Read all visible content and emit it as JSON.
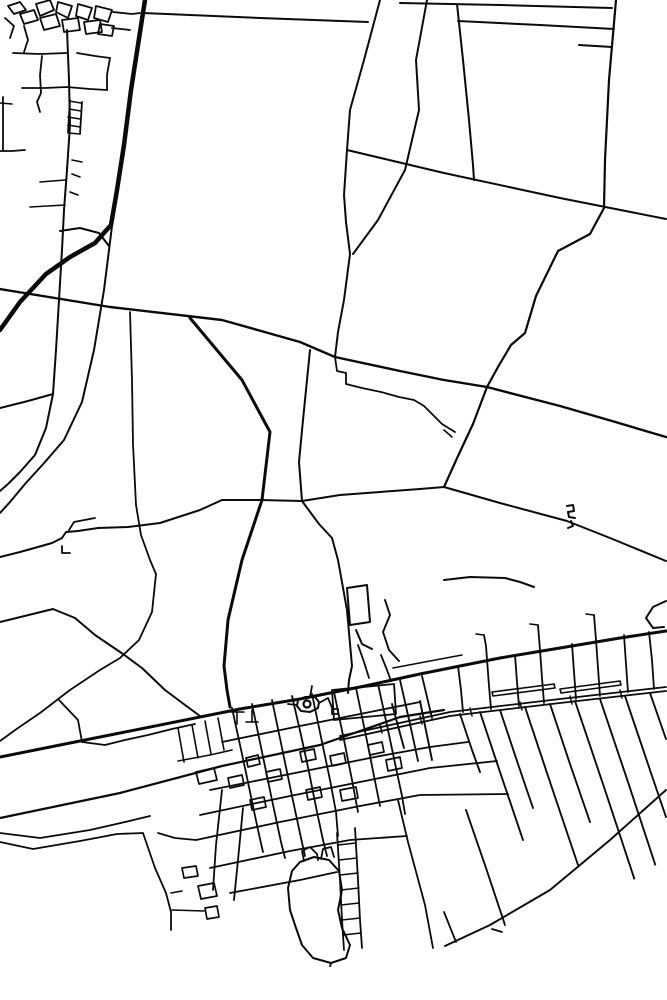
{
  "map": {
    "background": "#ffffff",
    "stroke": "#0a0a0a",
    "canvas": {
      "width": 667,
      "height": 1000
    },
    "clip_circle": {
      "cx": 333,
      "cy": 405,
      "r": 562
    },
    "circles": [
      {
        "cx": 307,
        "cy": 704,
        "r": 3.5,
        "w": 2.2
      }
    ],
    "roads": [
      {
        "w": 1.8,
        "p": "8,6 20,2 26,10 14,14 8,6"
      },
      {
        "w": 1.8,
        "p": "20,14 34,10 38,20 24,24 20,14"
      },
      {
        "w": 1.8,
        "p": "36,4 50,0 54,10 40,16 36,4"
      },
      {
        "w": 1.8,
        "p": "40,18 56,14 60,26 44,30 40,18"
      },
      {
        "w": 1.8,
        "p": "58,2 72,6 68,18 56,12 58,2"
      },
      {
        "w": 1.8,
        "p": "62,20 78,18 80,30 64,32 62,20"
      },
      {
        "w": 1.8,
        "p": "78,4 92,8 88,20 76,16 78,4"
      },
      {
        "w": 1.8,
        "p": "84,22 100,20 102,32 86,34 84,22"
      },
      {
        "w": 1.8,
        "p": "96,6 112,10 108,22 94,18 96,6"
      },
      {
        "w": 1.8,
        "p": "100,24 114,26 112,36 98,34 100,24"
      },
      {
        "w": 1.8,
        "p": "5,18 14,26 10,38"
      },
      {
        "w": 1.8,
        "p": "24,26 28,40 24,52"
      },
      {
        "w": 1.8,
        "p": "113,12 132,14 140,13"
      },
      {
        "w": 1.8,
        "p": "112,28 130,30"
      },
      {
        "w": 1.8,
        "p": "13,53 40,54 67,53"
      },
      {
        "w": 1.8,
        "p": "22,88 45,88 67,87 90,89 107,90"
      },
      {
        "w": 1.8,
        "p": "42,56 40,75 41,93 37,102 40,112"
      },
      {
        "w": 1.8,
        "p": "3,97 3,126 3,150"
      },
      {
        "w": 1.8,
        "p": "0,151 12,151 25,150"
      },
      {
        "w": 1.8,
        "p": "77,53 95,56 110,58"
      },
      {
        "w": 1.8,
        "p": "110,58 107,75 107,90"
      },
      {
        "w": 1.8,
        "p": "70,100 69,116 68,132"
      },
      {
        "w": 1.8,
        "p": "82,102 81,118 80,134"
      },
      {
        "w": 1.6,
        "p": "69,101 81,103"
      },
      {
        "w": 1.6,
        "p": "69,109 81,111"
      },
      {
        "w": 1.6,
        "p": "68,117 80,119"
      },
      {
        "w": 1.6,
        "p": "68,125 80,127"
      },
      {
        "w": 1.6,
        "p": "68,133 80,134"
      },
      {
        "w": 1.6,
        "p": "72,160 82,162"
      },
      {
        "w": 1.6,
        "p": "72,174 80,177"
      },
      {
        "w": 1.6,
        "p": "70,192 78,195"
      },
      {
        "w": 1.6,
        "p": "40,182 65,180"
      },
      {
        "w": 1.6,
        "p": "30,207 65,205"
      },
      {
        "w": 1.6,
        "p": "0,103 12,104"
      },
      {
        "w": 2,
        "p": "67,30 69,80 70,125 67,170 64,210 62,250 59,300 56,350 53,394 46,428 35,455 20,472 8,484 0,491"
      },
      {
        "w": 2,
        "p": "53,394 28,401 0,408"
      },
      {
        "w": 2,
        "p": "60,231 80,228 99,233 109,246"
      },
      {
        "w": 4.5,
        "p": "145,0 138,45 131,90 124,145 117,190 111,225 95,243 70,257 46,274 20,302 0,330"
      },
      {
        "w": 2,
        "p": "112,226 104,290 94,350 82,402 64,440 45,462 25,484 10,502 0,513"
      },
      {
        "w": 1.8,
        "p": "130,312 132,380 133,444 136,505 141,535 150,560 156,574 152,612 139,640 120,658 100,670 70,690 40,713 18,728 0,741"
      },
      {
        "w": 2,
        "p": "143,13 260,18 368,22"
      },
      {
        "w": 2,
        "p": "400,3 500,5 612,8"
      },
      {
        "w": 2,
        "p": "458,21 540,25 614,29"
      },
      {
        "w": 2,
        "p": "579,45 612,47"
      },
      {
        "w": 2,
        "p": "380,0 364,60 350,110 347,150 344,195 346,222 350,254 344,300 338,332 335,357"
      },
      {
        "w": 2,
        "p": "427,0 416,60 419,110 405,170 378,220 353,254"
      },
      {
        "w": 2,
        "p": "347,150 444,173 560,198 666,219"
      },
      {
        "w": 2,
        "p": "457,4 463,60 469,120 473,165 474,180"
      },
      {
        "w": 2.2,
        "p": "616,0 609,80 605,160 604,208 590,234 558,251 536,296 525,333 511,345 498,367 487,387 473,424 458,456 444,487"
      },
      {
        "w": 2.4,
        "p": "0,289 110,307 222,320 300,342 335,357 400,371 444,380 487,387 560,406 612,421 666,437"
      },
      {
        "w": 1.8,
        "p": "335,357 337,371 346,373 346,384 362,388 381,392 399,397 414,400 424,406 442,424 455,432"
      },
      {
        "w": 3,
        "p": "190,318 242,380 270,432 262,500 242,560 228,620 224,666 227,690 230,707"
      },
      {
        "w": 2,
        "p": "310,350 303,420 299,462 302,501 319,524 332,538 338,560 347,610 352,666 349,680 348,693"
      },
      {
        "w": 2,
        "p": "0,557 20,552 38,547 52,543 62,538 66,532 78,531 98,528 128,527 160,523 200,510 222,500 260,500 302,501 340,495 380,492 420,489 444,487"
      },
      {
        "w": 1.8,
        "p": "69,530 74,522 95,518"
      },
      {
        "w": 1.8,
        "p": "62,546 62,553 70,553"
      },
      {
        "w": 2,
        "p": "0,622 53,609 75,618 95,635 123,654 142,668 165,690 185,705 200,716"
      },
      {
        "w": 2,
        "p": "444,487 500,503 567,521 610,538 666,561"
      },
      {
        "w": 2,
        "p": "567,506 573,505 574,511 568,512 569,517 575,518"
      },
      {
        "w": 2,
        "p": "571,521 573,526 568,528"
      },
      {
        "w": 2,
        "p": "444,580 470,577 505,578 520,582 534,587"
      },
      {
        "w": 2,
        "p": "666,601 653,607 646,618 653,628 664,627"
      },
      {
        "w": 2,
        "p": "347,588 367,585 370,622 350,625 347,588"
      },
      {
        "w": 2,
        "p": "356,630 362,644 372,649"
      },
      {
        "w": 1.9,
        "p": "385,600 390,615 383,632 389,650 399,661"
      },
      {
        "w": 3,
        "p": "0,757 120,733 240,709 300,699 360,687 420,674 460,666 500,658 560,648 620,638 666,631"
      },
      {
        "w": 1.6,
        "p": "393,668 430,661 462,655"
      },
      {
        "w": 2.2,
        "p": "0,818 120,793 222,766 320,745 400,717 444,710"
      },
      {
        "w": 1.8,
        "p": "340,736 450,712 560,699 666,687"
      },
      {
        "w": 1.8,
        "p": "340,740 450,716 560,703 666,691"
      },
      {
        "w": 1.5,
        "p": "380,725 382,733"
      },
      {
        "w": 1.5,
        "p": "420,716 422,724"
      },
      {
        "w": 1.5,
        "p": "470,708 472,716"
      },
      {
        "w": 1.5,
        "p": "520,702 522,710"
      },
      {
        "w": 1.5,
        "p": "570,696 572,704"
      },
      {
        "w": 1.5,
        "p": "620,690 622,698"
      },
      {
        "w": 1.6,
        "p": "492,692 554,684 555,688 493,696 492,692"
      },
      {
        "w": 1.6,
        "p": "560,689 620,681 621,685 561,693 560,689"
      },
      {
        "w": 1.8,
        "p": "0,842 33,849 80,841 117,834 143,833 155,868 166,893 171,912 171,930"
      },
      {
        "w": 1.8,
        "p": "0,833 40,838 90,830 125,822 150,816"
      },
      {
        "w": 1.8,
        "p": "58,699 78,720 82,742 105,745 125,740 148,735 172,729 195,724"
      },
      {
        "w": 1.6,
        "p": "178,728 184,762"
      },
      {
        "w": 1.6,
        "p": "192,725 198,758"
      },
      {
        "w": 1.6,
        "p": "205,721 211,754"
      },
      {
        "w": 1.6,
        "p": "218,718 224,750"
      },
      {
        "w": 1.6,
        "p": "178,761 210,755 232,750"
      },
      {
        "w": 1.7,
        "p": "196,772 214,768 217,780 199,784 196,772"
      },
      {
        "w": 2,
        "p": "298,700 305,697 315,697 319,702 318,708 310,712 301,711 297,706 298,700"
      },
      {
        "w": 1.8,
        "p": "288,704 297,705"
      },
      {
        "w": 1.8,
        "p": "310,697 312,686"
      },
      {
        "w": 1.8,
        "p": "319,703 328,698"
      },
      {
        "w": 1.8,
        "p": "328,698 333,710"
      },
      {
        "w": 1.8,
        "p": "332,709 338,709 338,714 332,714 332,709"
      },
      {
        "w": 1.8,
        "p": "332,690 394,684 396,714 334,720 332,690"
      },
      {
        "w": 1.6,
        "p": "237,712 237,724"
      },
      {
        "w": 1.6,
        "p": "231,712 244,712"
      },
      {
        "w": 1.6,
        "p": "252,710 252,722"
      },
      {
        "w": 1.6,
        "p": "246,722 258,722"
      },
      {
        "w": 1.8,
        "p": "222,742 300,726 380,710 420,702"
      },
      {
        "w": 1.8,
        "p": "210,790 300,772 380,756 430,747 468,742"
      },
      {
        "w": 1.8,
        "p": "200,815 290,796 370,780 430,768 497,761"
      },
      {
        "w": 1.8,
        "p": "196,840 280,822 360,806 420,795 508,794"
      },
      {
        "w": 1.8,
        "p": "210,868 290,851 350,840 407,836"
      },
      {
        "w": 1.8,
        "p": "230,893 300,880 337,872"
      },
      {
        "w": 1.8,
        "p": "232,708 245,768 258,830 263,852"
      },
      {
        "w": 1.8,
        "p": "252,704 262,752 272,800 281,842 285,858"
      },
      {
        "w": 1.8,
        "p": "272,700 282,748 292,796 301,838 305,856"
      },
      {
        "w": 1.8,
        "p": "292,696 301,735 309,772 317,812 323,840 327,856"
      },
      {
        "w": 1.8,
        "p": "312,694 322,742 330,780 336,812 338,836"
      },
      {
        "w": 1.8,
        "p": "334,692 344,740 352,780 358,812"
      },
      {
        "w": 1.8,
        "p": "356,688 366,736 374,776 380,806"
      },
      {
        "w": 1.8,
        "p": "378,684 388,730 396,768 402,796 405,814"
      },
      {
        "w": 1.8,
        "p": "400,680 410,724 418,761"
      },
      {
        "w": 1.8,
        "p": "422,676 432,718"
      },
      {
        "w": 1.8,
        "p": "398,800 408,842 425,905 433,948"
      },
      {
        "w": 1.8,
        "p": "337,833 340,880 342,920 344,950"
      },
      {
        "w": 1.8,
        "p": "355,828 358,880 360,920 362,948"
      },
      {
        "w": 1.5,
        "p": "338,845 356,843"
      },
      {
        "w": 1.5,
        "p": "339,860 357,858"
      },
      {
        "w": 1.5,
        "p": "340,875 358,873"
      },
      {
        "w": 1.5,
        "p": "341,890 359,888"
      },
      {
        "w": 1.5,
        "p": "341,905 359,903"
      },
      {
        "w": 1.5,
        "p": "342,920 360,918"
      },
      {
        "w": 1.5,
        "p": "343,935 361,933"
      },
      {
        "w": 2,
        "p": "300,862 314,857 329,860 339,871 342,890 338,910 342,928 350,945 346,958 331,963 313,958 302,945 296,928 290,910 288,888 292,871 300,862"
      },
      {
        "w": 1.8,
        "p": "304,861 302,851 310,847 317,854 318,860"
      },
      {
        "w": 1.8,
        "p": "321,859 323,849 331,847 334,857"
      },
      {
        "w": 1.8,
        "p": "331,963 326,982 331,998"
      },
      {
        "w": 1.7,
        "p": "182,868 196,866 198,876 184,878 182,868"
      },
      {
        "w": 1.7,
        "p": "198,886 214,883 217,896 201,899 198,886"
      },
      {
        "w": 1.7,
        "p": "205,908 217,906 219,917 207,919 205,908"
      },
      {
        "w": 1.6,
        "p": "171,893 182,891"
      },
      {
        "w": 1.6,
        "p": "172,910 204,911"
      },
      {
        "w": 1.7,
        "p": "246,758 258,755 260,764 248,767 246,758"
      },
      {
        "w": 1.7,
        "p": "266,772 280,769 282,779 268,782 266,772"
      },
      {
        "w": 1.7,
        "p": "300,752 314,749 316,759 302,762 300,752"
      },
      {
        "w": 1.7,
        "p": "330,756 344,753 346,763 332,766 330,756"
      },
      {
        "w": 1.7,
        "p": "306,790 320,787 322,797 308,800 306,790"
      },
      {
        "w": 1.7,
        "p": "340,790 356,787 358,798 342,801 340,790"
      },
      {
        "w": 1.7,
        "p": "250,800 264,797 266,807 252,810 250,800"
      },
      {
        "w": 1.7,
        "p": "228,778 242,775 244,785 230,788 228,778"
      },
      {
        "w": 1.7,
        "p": "368,745 382,742 384,752 370,755 368,745"
      },
      {
        "w": 1.7,
        "p": "386,760 400,757 402,768 388,771 386,760"
      },
      {
        "w": 1.8,
        "p": "458,666 461,690 463,712"
      },
      {
        "w": 1.8,
        "p": "484,635 486,646 489,686 491,709"
      },
      {
        "w": 1.6,
        "p": "476,634 484,635"
      },
      {
        "w": 1.8,
        "p": "515,655 517,682 519,706"
      },
      {
        "w": 1.8,
        "p": "538,625 540,650 542,678 544,703"
      },
      {
        "w": 1.6,
        "p": "530,624 538,625"
      },
      {
        "w": 1.8,
        "p": "572,644 574,672 576,699"
      },
      {
        "w": 1.8,
        "p": "594,615 596,640 598,668 600,696"
      },
      {
        "w": 1.6,
        "p": "586,614 594,615"
      },
      {
        "w": 1.8,
        "p": "624,635 626,664 628,692"
      },
      {
        "w": 1.8,
        "p": "649,632 652,660 654,689"
      },
      {
        "w": 1.9,
        "p": "392,704 404,748"
      },
      {
        "w": 1.9,
        "p": "420,701 432,760"
      },
      {
        "w": 1.9,
        "p": "460,714 472,750 480,772"
      },
      {
        "w": 1.9,
        "p": "480,712 500,772 523,840"
      },
      {
        "w": 1.9,
        "p": "500,710 518,764 533,808"
      },
      {
        "w": 1.9,
        "p": "525,707 550,782 578,865"
      },
      {
        "w": 1.9,
        "p": "550,704 570,764 590,822"
      },
      {
        "w": 1.9,
        "p": "575,701 605,790 641,899"
      },
      {
        "w": 1.9,
        "p": "600,699 628,782 656,867"
      },
      {
        "w": 1.9,
        "p": "625,696 652,776 666,817"
      },
      {
        "w": 1.9,
        "p": "650,693 666,739"
      },
      {
        "w": 1.9,
        "p": "466,810 486,868 505,925"
      },
      {
        "w": 1.8,
        "p": "444,912 456,942"
      },
      {
        "w": 1.8,
        "p": "492,929 502,932"
      },
      {
        "w": 1.9,
        "p": "666,790 610,840 550,890 490,925 445,946"
      },
      {
        "w": 1.8,
        "p": "243,808 238,860 234,900"
      },
      {
        "w": 1.8,
        "p": "222,790 216,845 213,890"
      },
      {
        "w": 1.8,
        "p": "196,840 175,838 158,833"
      },
      {
        "w": 1.8,
        "p": "358,645 364,662 369,678"
      },
      {
        "w": 1.8,
        "p": "381,655 387,670 391,681"
      },
      {
        "w": 1.6,
        "p": "444,430 452,437"
      }
    ]
  }
}
